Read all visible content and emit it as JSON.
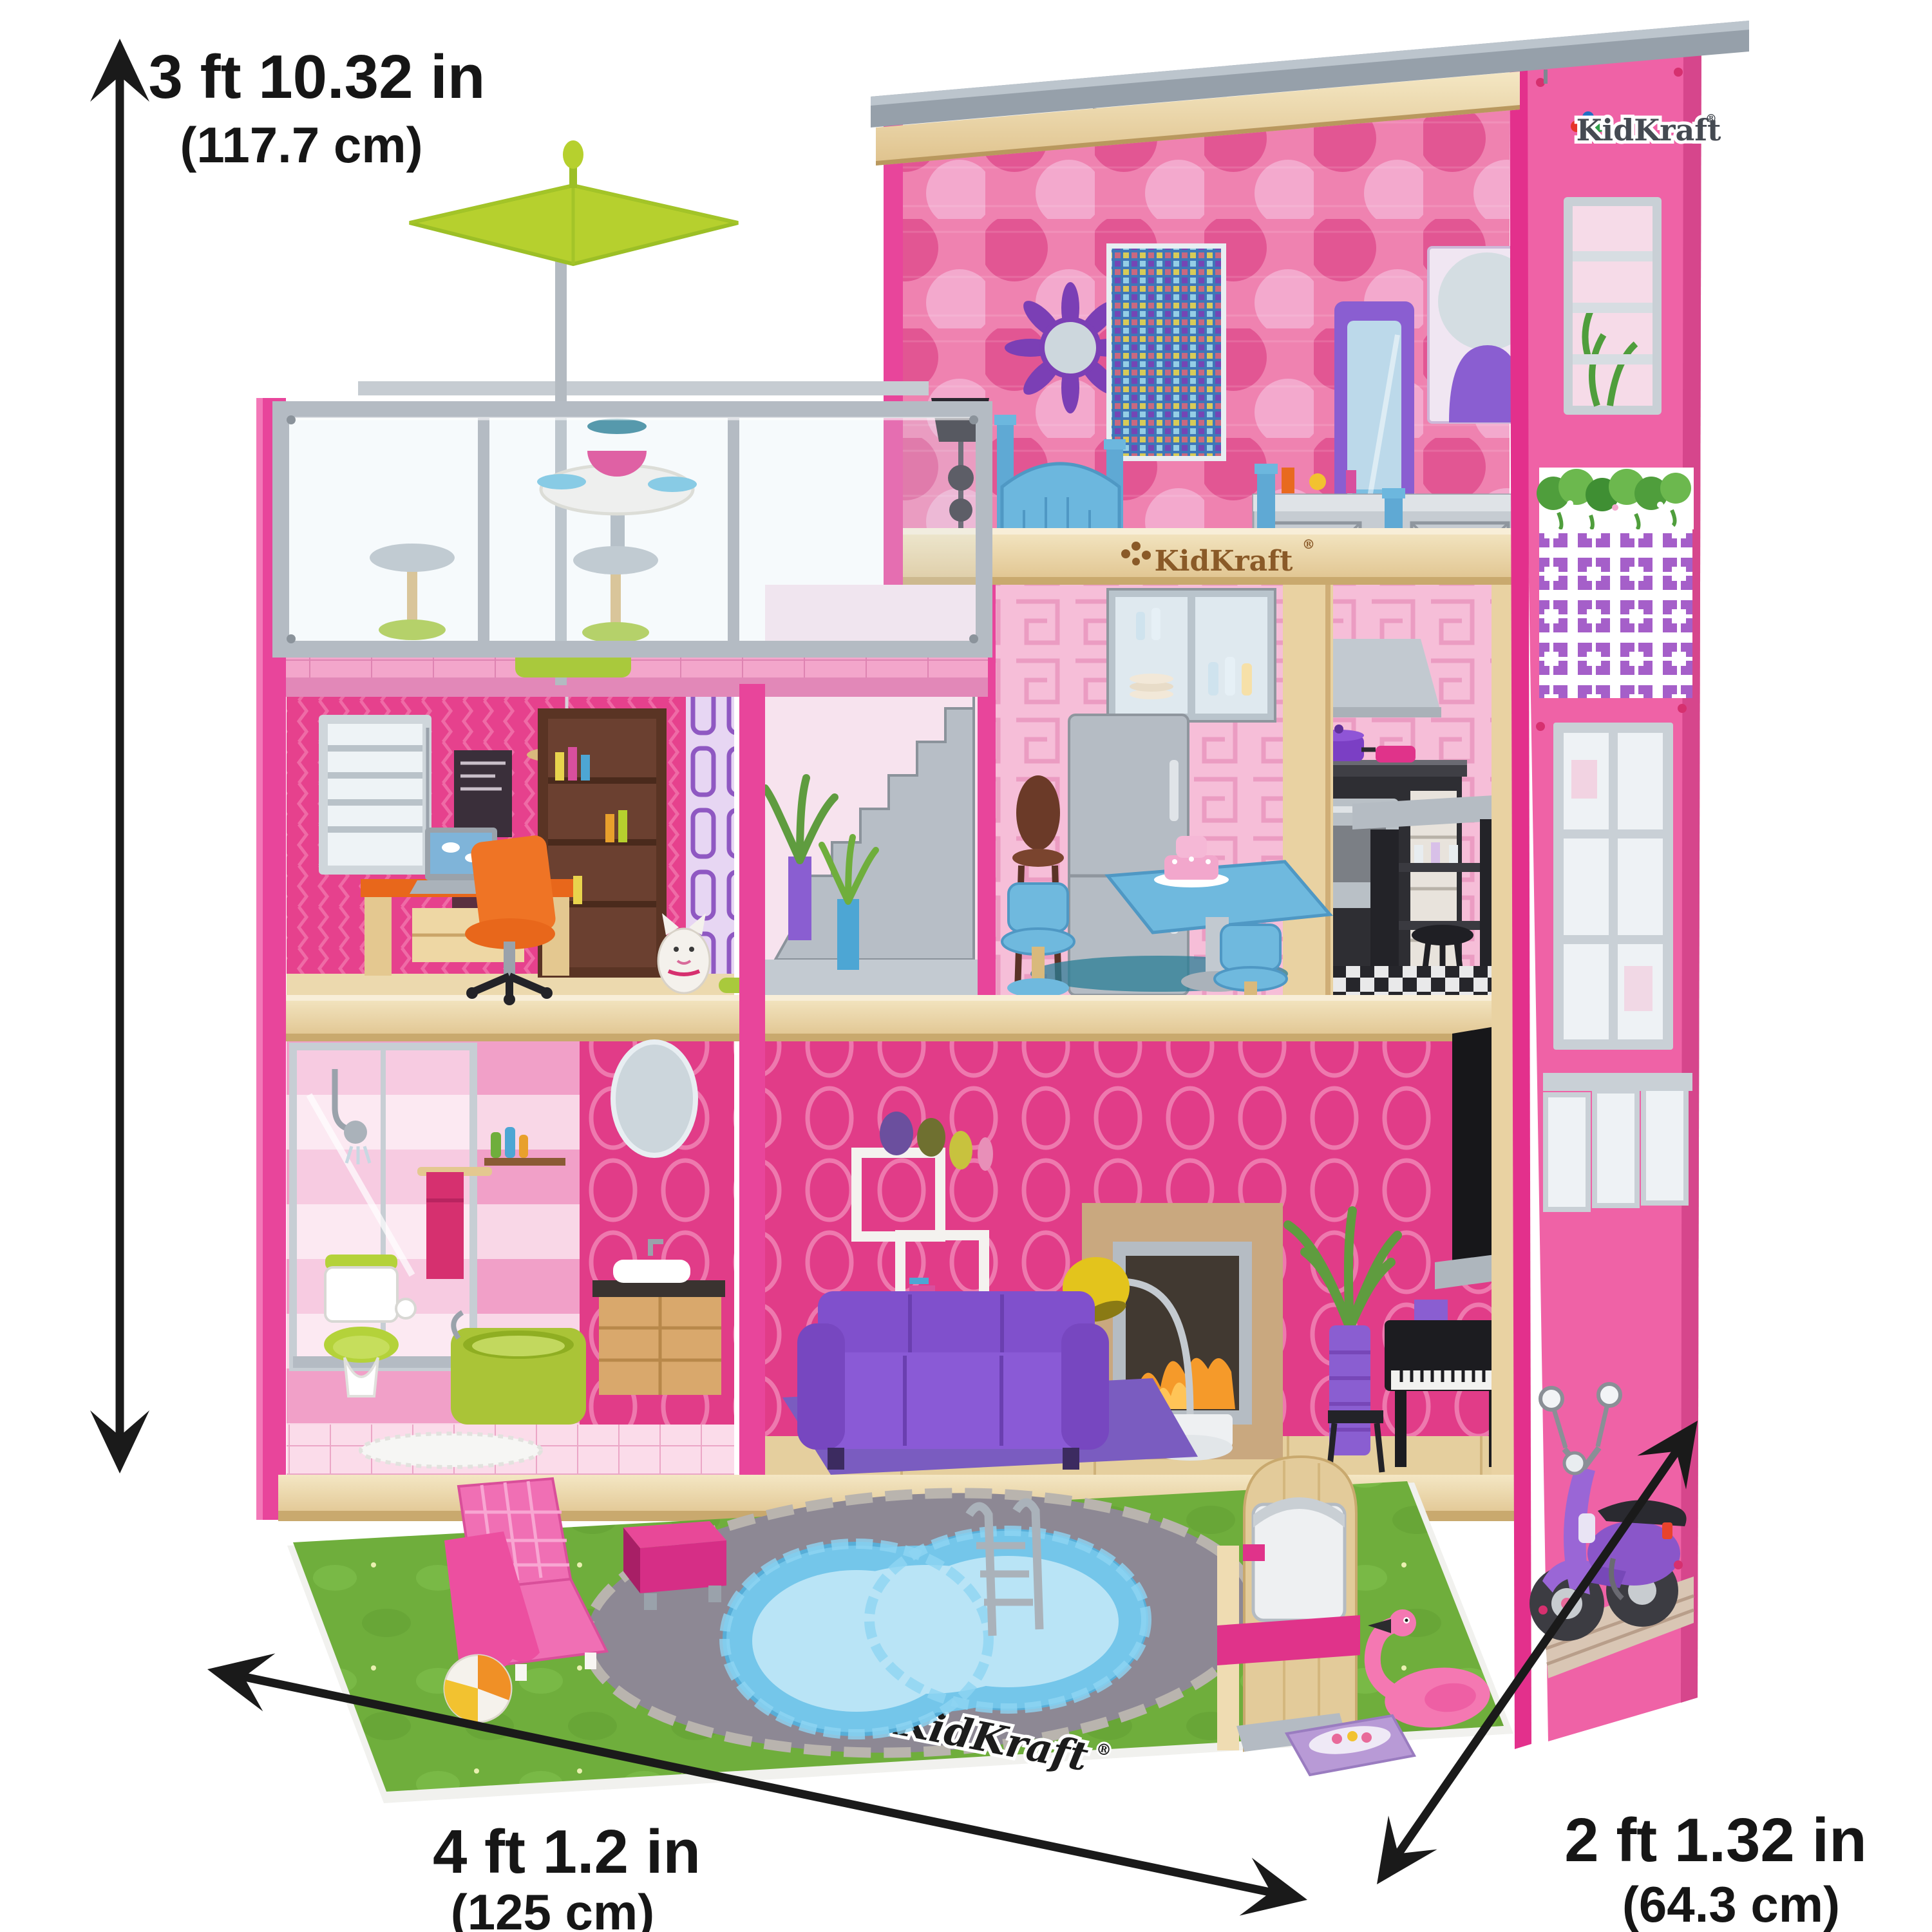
{
  "annotations": {
    "height": {
      "imperial": "3 ft 10.32 in",
      "metric": "(117.7 cm)"
    },
    "width": {
      "imperial": "4 ft 1.2 in",
      "metric": "(125 cm)"
    },
    "depth": {
      "imperial": "2 ft 1.32 in",
      "metric": "(64.3 cm)"
    }
  },
  "brand": {
    "name": "KidKraft",
    "registered_mark": "®"
  },
  "logos": {
    "side_panel": "KidKraft",
    "floor_beam": "KidKraft",
    "yard_mat": "KidKraft"
  },
  "palette": {
    "house_pink": "#e8459b",
    "panel_pink": "#ef62a6",
    "wood": "#ead7ab",
    "roof_gray": "#96a0aa",
    "accent_green": "#b6d02e",
    "accent_blue": "#6fb9de",
    "accent_purple": "#7b3fc4",
    "accent_yellow": "#e3c41c",
    "accent_orange": "#e8671b",
    "grass_green": "#71ad3c",
    "pool_blue": "#74c6ea",
    "arrow_black": "#1a1a1a"
  }
}
